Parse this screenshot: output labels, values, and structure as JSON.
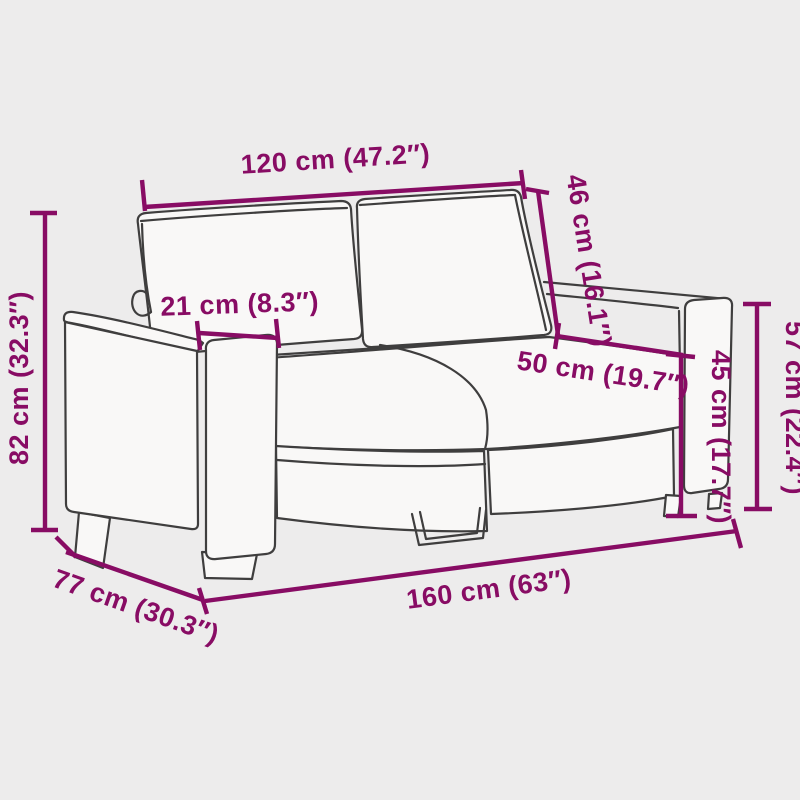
{
  "page": {
    "background": "#edecec",
    "subject": "2-seater sofa line drawing with dimension annotations"
  },
  "colors": {
    "dimension_annotation": "#880c64",
    "line_art": "#3f3e3e",
    "sofa_fill": "#f9f8f7"
  },
  "dimensions": {
    "backrest_width": {
      "label": "120 cm (47.2″)",
      "cm": 120,
      "inches": 47.2
    },
    "backrest_height": {
      "label": "46 cm (16.1″)",
      "cm": 46,
      "inches": 16.1
    },
    "armrest_width": {
      "label": "21 cm (8.3″)",
      "cm": 21,
      "inches": 8.3
    },
    "seat_depth": {
      "label": "50 cm (19.7″)",
      "cm": 50,
      "inches": 19.7
    },
    "seat_height": {
      "label": "45 cm (17.7″)",
      "cm": 45,
      "inches": 17.7
    },
    "armrest_height": {
      "label": "57 cm (22.4″)",
      "cm": 57,
      "inches": 22.4
    },
    "total_height": {
      "label": "82 cm (32.3″)",
      "cm": 82,
      "inches": 32.3
    },
    "total_depth": {
      "label": "77 cm (30.3″)",
      "cm": 77,
      "inches": 30.3
    },
    "total_width": {
      "label": "160 cm (63″)",
      "cm": 160,
      "inches": 63
    }
  }
}
